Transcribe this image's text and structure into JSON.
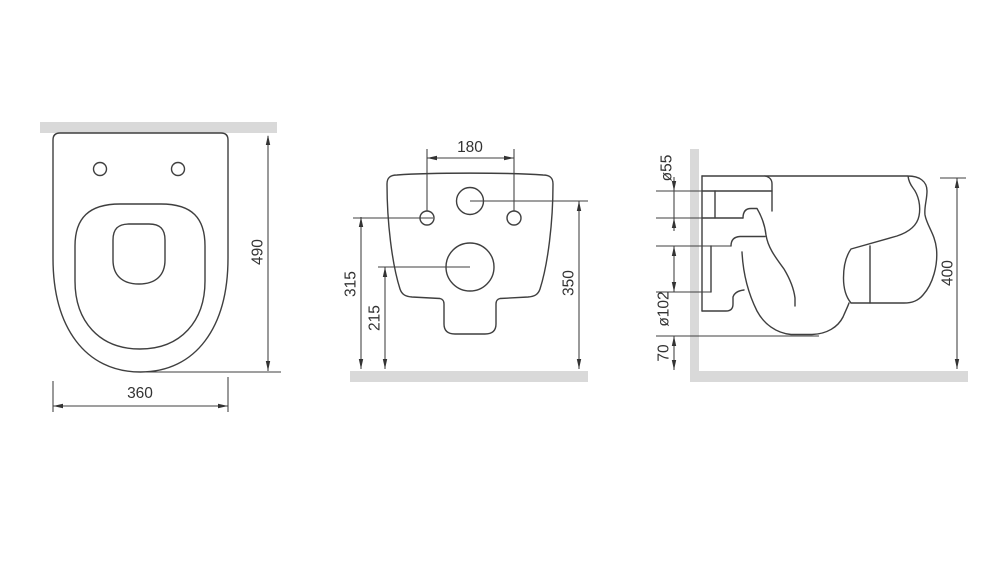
{
  "views": {
    "top": {
      "width_label": "360",
      "depth_label": "490"
    },
    "front": {
      "bolt_spacing_label": "180",
      "bolt_height_label": "315",
      "outlet_height_label": "215",
      "inlet_height_label": "350"
    },
    "side": {
      "inlet_diameter_label": "ø55",
      "outlet_diameter_label": "ø102",
      "clearance_label": "70",
      "height_label": "400"
    }
  },
  "colors": {
    "line": "#3f3f3f",
    "text": "#333333",
    "surface": "#d9d9d9",
    "background": "#ffffff"
  }
}
